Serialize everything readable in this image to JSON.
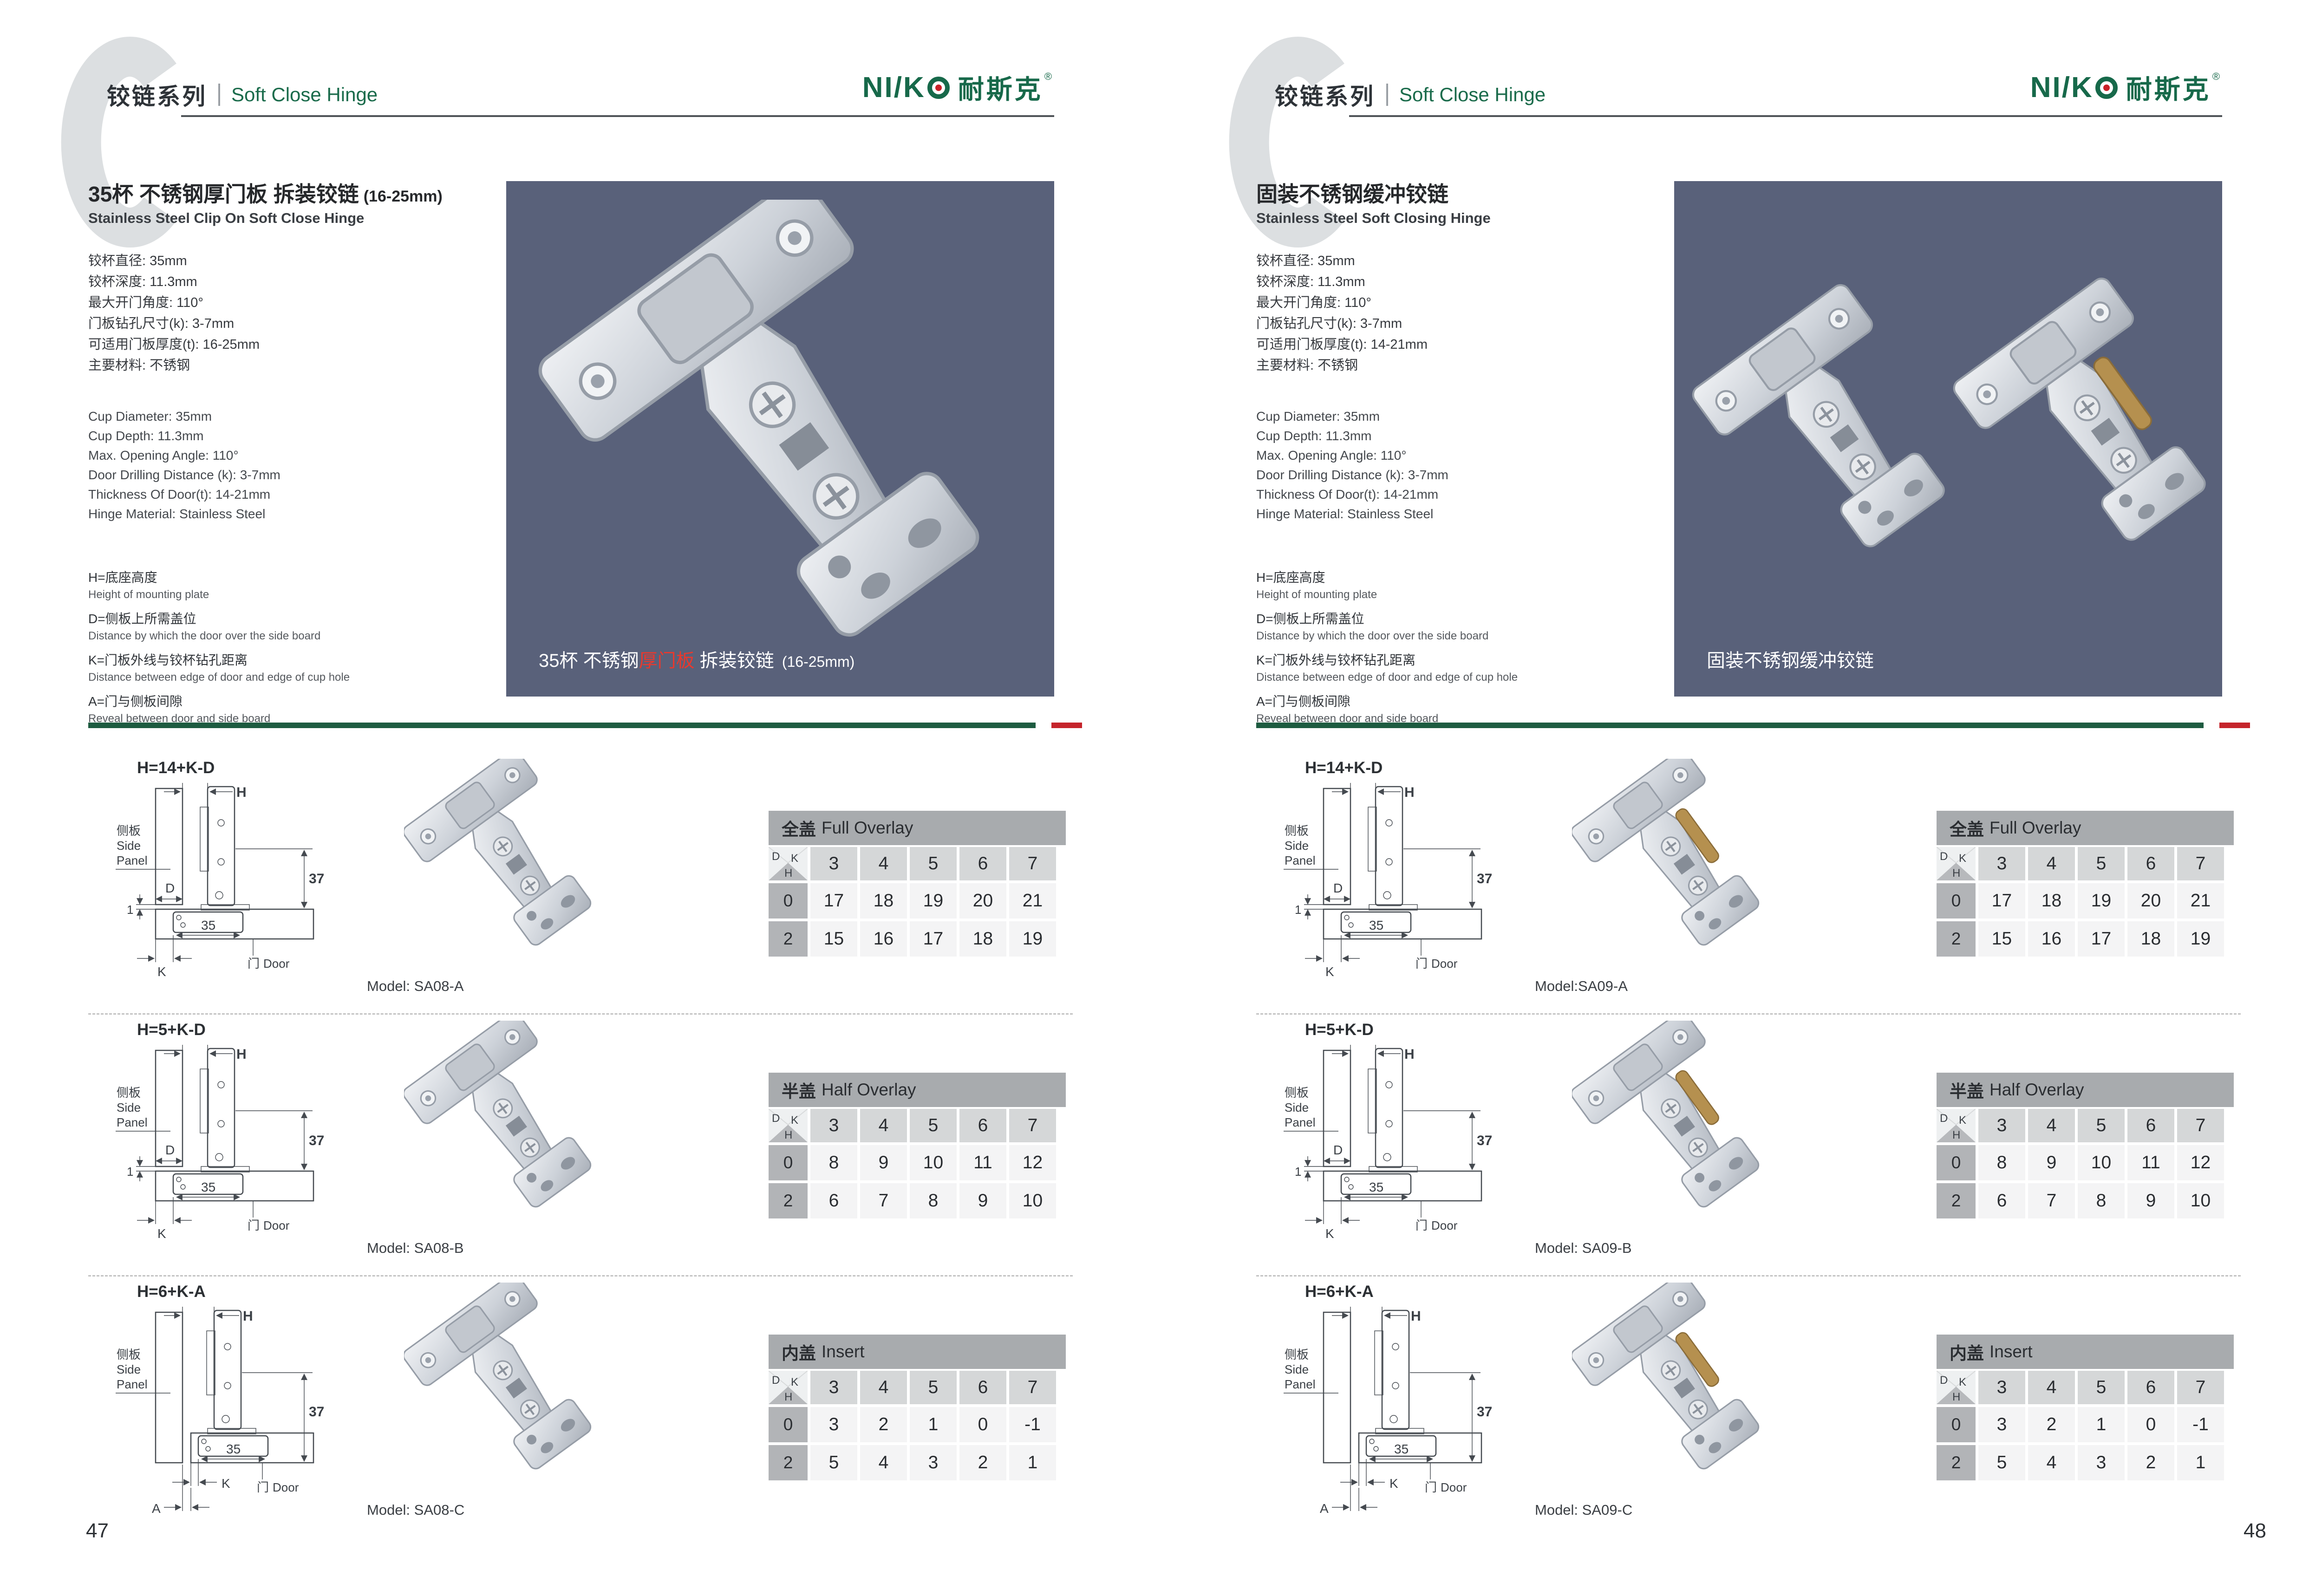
{
  "colors": {
    "brand_green": "#17694a",
    "accent_red": "#c5242b",
    "photo_background": "#59617a",
    "divider_green": "#1d5b40"
  },
  "brand": {
    "logo_latin": "NI/K",
    "logo_cn": "耐斯克",
    "registered": "®"
  },
  "drawing_labels": {
    "side_panel_cn": "侧板",
    "side_panel_en1": "Side",
    "side_panel_en2": "Panel",
    "door_cn": "门",
    "door_en": "Door",
    "dim_h": "H",
    "dim_d": "D",
    "dim_k": "K",
    "dim_a": "A",
    "dim_37": "37",
    "dim_35": "35",
    "dim_1": "1"
  },
  "table_corner": {
    "d": "D",
    "k": "K",
    "h": "H"
  },
  "pages": [
    {
      "page_number": "47",
      "header": {
        "watermark": "C",
        "series_cn": "铰链系列",
        "series_en": "Soft Close Hinge"
      },
      "intro": {
        "title_cn": "35杯 不锈钢厚门板 拆装铰链",
        "title_suffix": "(16-25mm)",
        "subtitle_en": "Stainless Steel Clip On Soft Close Hinge",
        "specs_cn": [
          "铰杯直径: 35mm",
          "铰杯深度: 11.3mm",
          "最大开门角度: 110°",
          "门板钻孔尺寸(k): 3-7mm",
          "可适用门板厚度(t): 16-25mm",
          "主要材料: 不锈钢"
        ],
        "specs_en": [
          "Cup Diameter: 35mm",
          "Cup Depth: 11.3mm",
          "Max. Opening Angle: 110°",
          "Door Drilling Distance (k): 3-7mm",
          "Thickness Of Door(t): 14-21mm",
          "Hinge Material: Stainless Steel"
        ],
        "legend": [
          {
            "cn": "H=底座高度",
            "en": "Height of mounting plate"
          },
          {
            "cn": "D=侧板上所需盖位",
            "en": "Distance by which the door over the side board"
          },
          {
            "cn": "K=门板外线与铰杯钻孔距离",
            "en": "Distance between edge of door and edge of cup hole"
          },
          {
            "cn": "A=门与侧板间隙",
            "en": "Reveal between door and side board"
          }
        ],
        "photo_caption": {
          "pre": "35杯 不锈钢",
          "red": "厚门板",
          "post": " 拆装铰链 ",
          "suffix": "(16-25mm)"
        }
      },
      "rows": [
        {
          "formula": "H=14+K-D",
          "model": "Model: SA08-A",
          "table": {
            "title_cn": "全盖",
            "title_en": "Full Overlay",
            "k_values": [
              "3",
              "4",
              "5",
              "6",
              "7"
            ],
            "data_rows": [
              {
                "h": "0",
                "values": [
                  "17",
                  "18",
                  "19",
                  "20",
                  "21"
                ]
              },
              {
                "h": "2",
                "values": [
                  "15",
                  "16",
                  "17",
                  "18",
                  "19"
                ]
              }
            ]
          }
        },
        {
          "formula": "H=5+K-D",
          "model": "Model: SA08-B",
          "table": {
            "title_cn": "半盖",
            "title_en": "Half Overlay",
            "k_values": [
              "3",
              "4",
              "5",
              "6",
              "7"
            ],
            "data_rows": [
              {
                "h": "0",
                "values": [
                  "8",
                  "9",
                  "10",
                  "11",
                  "12"
                ]
              },
              {
                "h": "2",
                "values": [
                  "6",
                  "7",
                  "8",
                  "9",
                  "10"
                ]
              }
            ]
          }
        },
        {
          "formula": "H=6+K-A",
          "model": "Model: SA08-C",
          "table": {
            "title_cn": "内盖",
            "title_en": "Insert",
            "k_values": [
              "3",
              "4",
              "5",
              "6",
              "7"
            ],
            "data_rows": [
              {
                "h": "0",
                "values": [
                  "3",
                  "2",
                  "1",
                  "0",
                  "-1"
                ]
              },
              {
                "h": "2",
                "values": [
                  "5",
                  "4",
                  "3",
                  "2",
                  "1"
                ]
              }
            ]
          }
        }
      ]
    },
    {
      "page_number": "48",
      "header": {
        "watermark": "C",
        "series_cn": "铰链系列",
        "series_en": "Soft Close Hinge"
      },
      "intro": {
        "title_cn": "固装不锈钢缓冲铰链",
        "title_suffix": "",
        "subtitle_en": "Stainless Steel Soft Closing Hinge",
        "specs_cn": [
          "铰杯直径: 35mm",
          "铰杯深度: 11.3mm",
          "最大开门角度: 110°",
          "门板钻孔尺寸(k): 3-7mm",
          "可适用门板厚度(t): 14-21mm",
          "主要材料: 不锈钢"
        ],
        "specs_en": [
          "Cup Diameter: 35mm",
          "Cup Depth: 11.3mm",
          "Max. Opening Angle: 110°",
          "Door Drilling Distance (k): 3-7mm",
          "Thickness Of Door(t): 14-21mm",
          "Hinge Material: Stainless Steel"
        ],
        "legend": [
          {
            "cn": "H=底座高度",
            "en": "Height of mounting plate"
          },
          {
            "cn": "D=侧板上所需盖位",
            "en": "Distance by which the door over the side board"
          },
          {
            "cn": "K=门板外线与铰杯钻孔距离",
            "en": "Distance between edge of door and edge of cup hole"
          },
          {
            "cn": "A=门与侧板间隙",
            "en": "Reveal between door and side board"
          }
        ],
        "photo_caption": {
          "pre": "固装不锈钢缓冲铰链",
          "red": "",
          "post": "",
          "suffix": ""
        }
      },
      "rows": [
        {
          "formula": "H=14+K-D",
          "model": "Model:SA09-A",
          "table": {
            "title_cn": "全盖",
            "title_en": "Full Overlay",
            "k_values": [
              "3",
              "4",
              "5",
              "6",
              "7"
            ],
            "data_rows": [
              {
                "h": "0",
                "values": [
                  "17",
                  "18",
                  "19",
                  "20",
                  "21"
                ]
              },
              {
                "h": "2",
                "values": [
                  "15",
                  "16",
                  "17",
                  "18",
                  "19"
                ]
              }
            ]
          }
        },
        {
          "formula": "H=5+K-D",
          "model": "Model: SA09-B",
          "table": {
            "title_cn": "半盖",
            "title_en": "Half Overlay",
            "k_values": [
              "3",
              "4",
              "5",
              "6",
              "7"
            ],
            "data_rows": [
              {
                "h": "0",
                "values": [
                  "8",
                  "9",
                  "10",
                  "11",
                  "12"
                ]
              },
              {
                "h": "2",
                "values": [
                  "6",
                  "7",
                  "8",
                  "9",
                  "10"
                ]
              }
            ]
          }
        },
        {
          "formula": "H=6+K-A",
          "model": "Model: SA09-C",
          "table": {
            "title_cn": "内盖",
            "title_en": "Insert",
            "k_values": [
              "3",
              "4",
              "5",
              "6",
              "7"
            ],
            "data_rows": [
              {
                "h": "0",
                "values": [
                  "3",
                  "2",
                  "1",
                  "0",
                  "-1"
                ]
              },
              {
                "h": "2",
                "values": [
                  "5",
                  "4",
                  "3",
                  "2",
                  "1"
                ]
              }
            ]
          }
        }
      ]
    }
  ]
}
